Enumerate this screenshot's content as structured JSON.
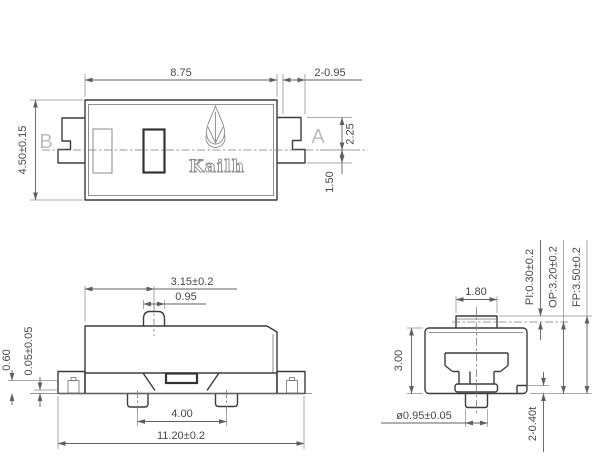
{
  "brand_logo": "Kailh",
  "colors": {
    "ink": "#3c3c3c",
    "dimension": "#5f5f5f",
    "muted_label": "#bdbdbd"
  },
  "top_view": {
    "body_width": "8.75",
    "body_height": "4.50±0.15",
    "tab_slots": "2-0.95",
    "tab_upper": "2.25",
    "tab_lower": "1.50",
    "section_left": "B",
    "section_right": "A"
  },
  "side_view": {
    "plunger_offset": "3.15±0.2",
    "plunger_width": "0.95",
    "coplanarity": "0.05±0.05",
    "terminal_height": "0.60",
    "feet_pitch": "4.00",
    "overall_width": "11.20±0.2"
  },
  "end_view": {
    "plunger_width": "1.80",
    "body_height": "3.00",
    "peg_diameter": "ø0.95±0.05",
    "terminal_thickness": "2-0.40t",
    "pretravel": "PI:0.30±0.2",
    "operating_position": "OP:3.20±0.2",
    "free_position": "FP:3.50±0.2"
  }
}
